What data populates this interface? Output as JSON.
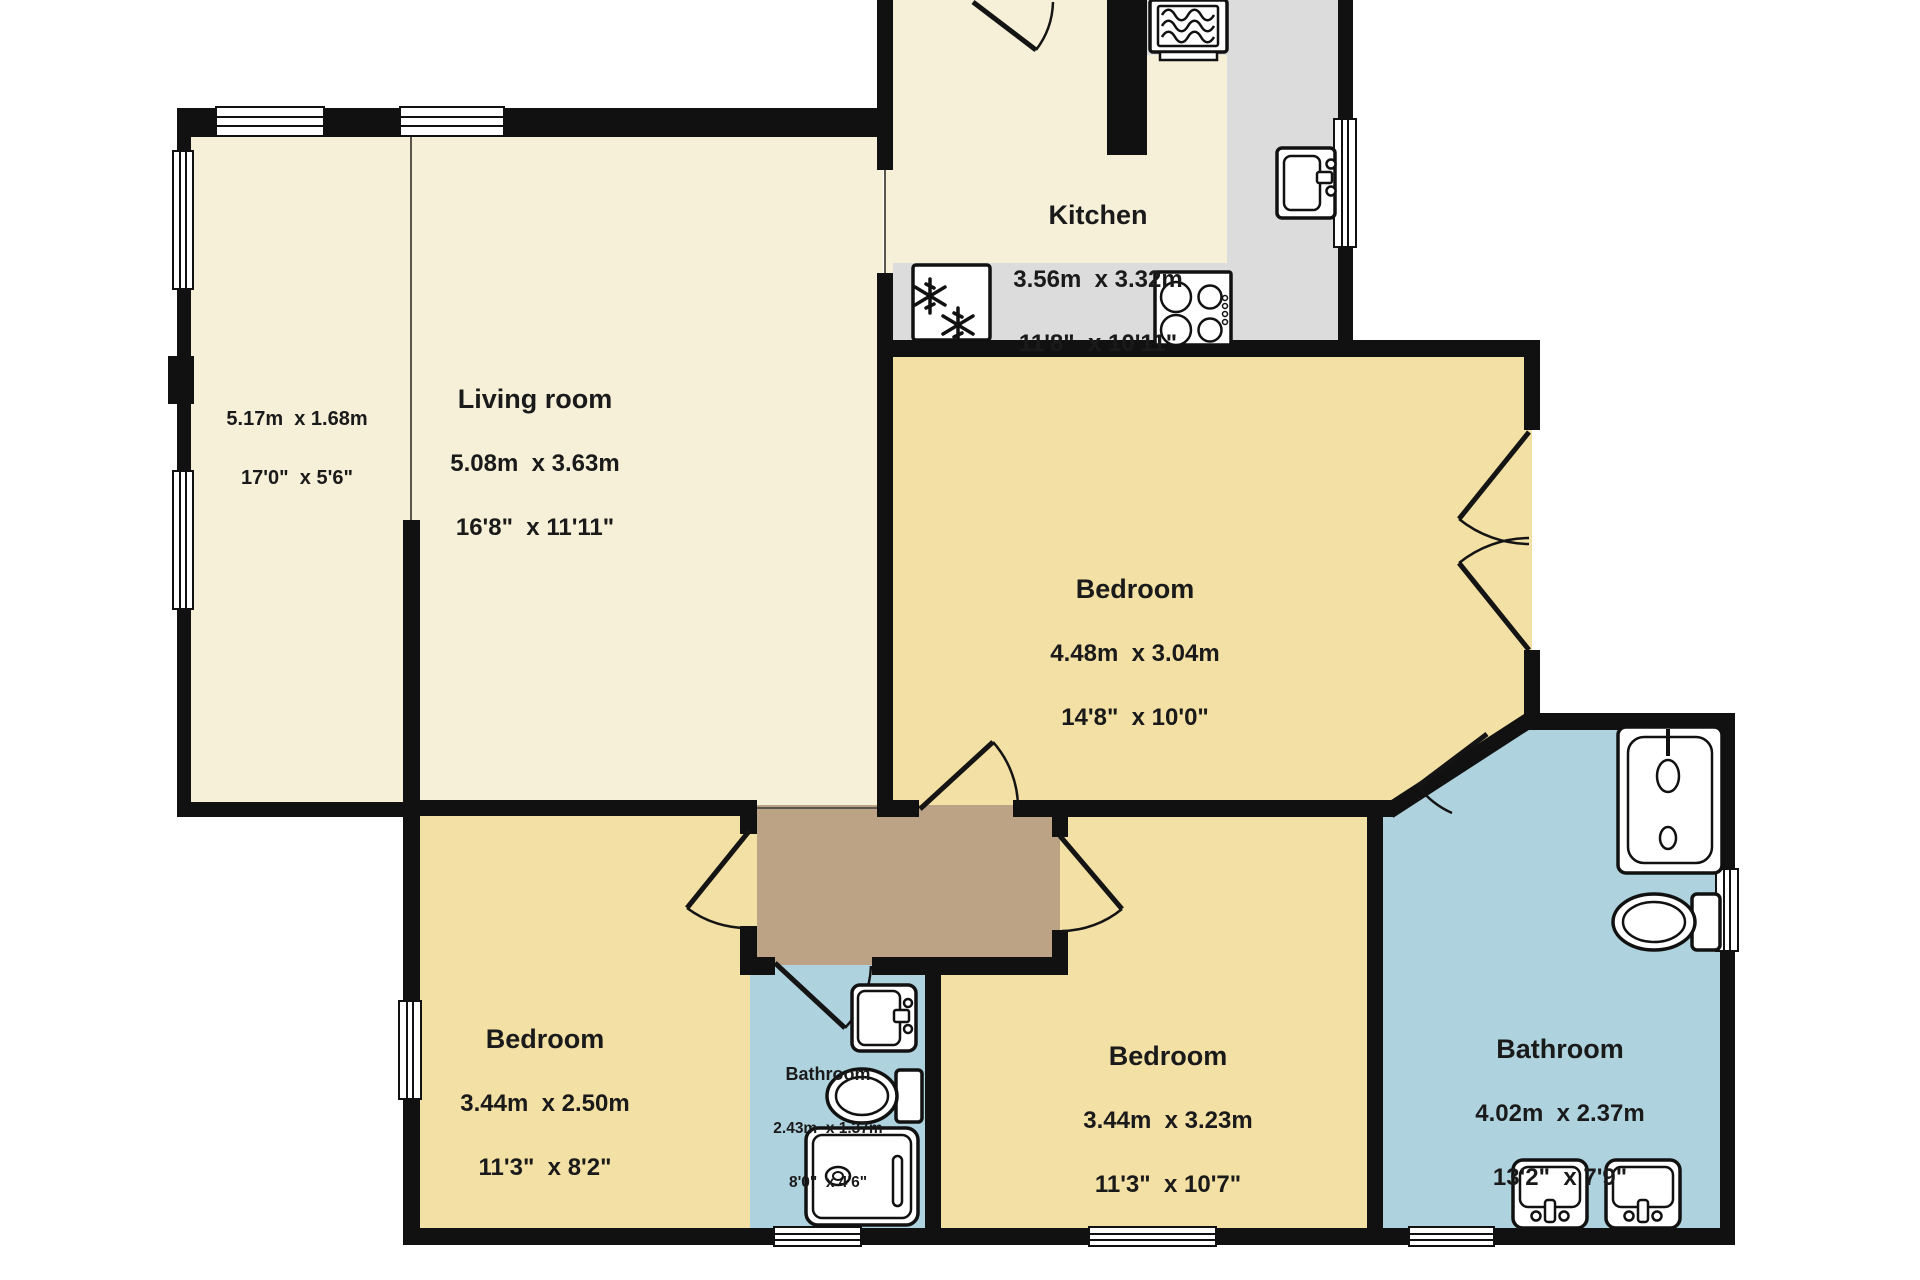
{
  "plan_title": "2 storey flat floor plan (cropped at top)",
  "colors": {
    "wall": "#111111",
    "room_cream": "#f6f0d8",
    "bedroom_yellow": "#f3e0a4",
    "bathroom_blue": "#aed3de",
    "hallway_brown": "#bda385",
    "counter_gray": "#dcdcdc",
    "text": "#1a1a1a",
    "outside": "#ffffff"
  },
  "rooms": {
    "kitchen": {
      "name": "Kitchen",
      "metric": "3.56m  x 3.32m",
      "imperial": "11'8\"  x 10'11\""
    },
    "living_room": {
      "name": "Living room",
      "metric": "5.08m  x 3.63m",
      "imperial": "16'8\"  x 11'11\""
    },
    "conservatory": {
      "name": "",
      "metric": "5.17m  x 1.68m",
      "imperial": "17'0\"  x 5'6\""
    },
    "bedroom_1": {
      "name": "Bedroom",
      "metric": "4.48m  x 3.04m",
      "imperial": "14'8\"  x 10'0\""
    },
    "bedroom_2": {
      "name": "Bedroom",
      "metric": "3.44m  x 2.50m",
      "imperial": "11'3\"  x 8'2\""
    },
    "bedroom_3": {
      "name": "Bedroom",
      "metric": "3.44m  x 3.23m",
      "imperial": "11'3\"  x 10'7\""
    },
    "bathroom_small": {
      "name": "Bathroom",
      "metric": "2.43m  x 1.37m",
      "imperial": "8'0\"  x 4'6\""
    },
    "bathroom_main": {
      "name": "Bathroom",
      "metric": "4.02m  x 2.37m",
      "imperial": "13'2\"  x 7'9\""
    }
  },
  "icons": {
    "oven": "appliance-with-wavy-lines",
    "fridge_freezer": "double-snowflake",
    "hob": "four-burner-hob",
    "kitchen_sink": "single-basin-sink-with-tap",
    "bath": "bathtub-with-tap-and-drain",
    "shower_bath": "shower-tray-with-drain",
    "toilet": "toilet-with-cistern",
    "wash_basin": "basin-with-tap",
    "entrance_door": "single-door-arc",
    "internal_door": "single-door-arc",
    "french_doors": "double-door-arcs",
    "window": "triple-line-window"
  }
}
